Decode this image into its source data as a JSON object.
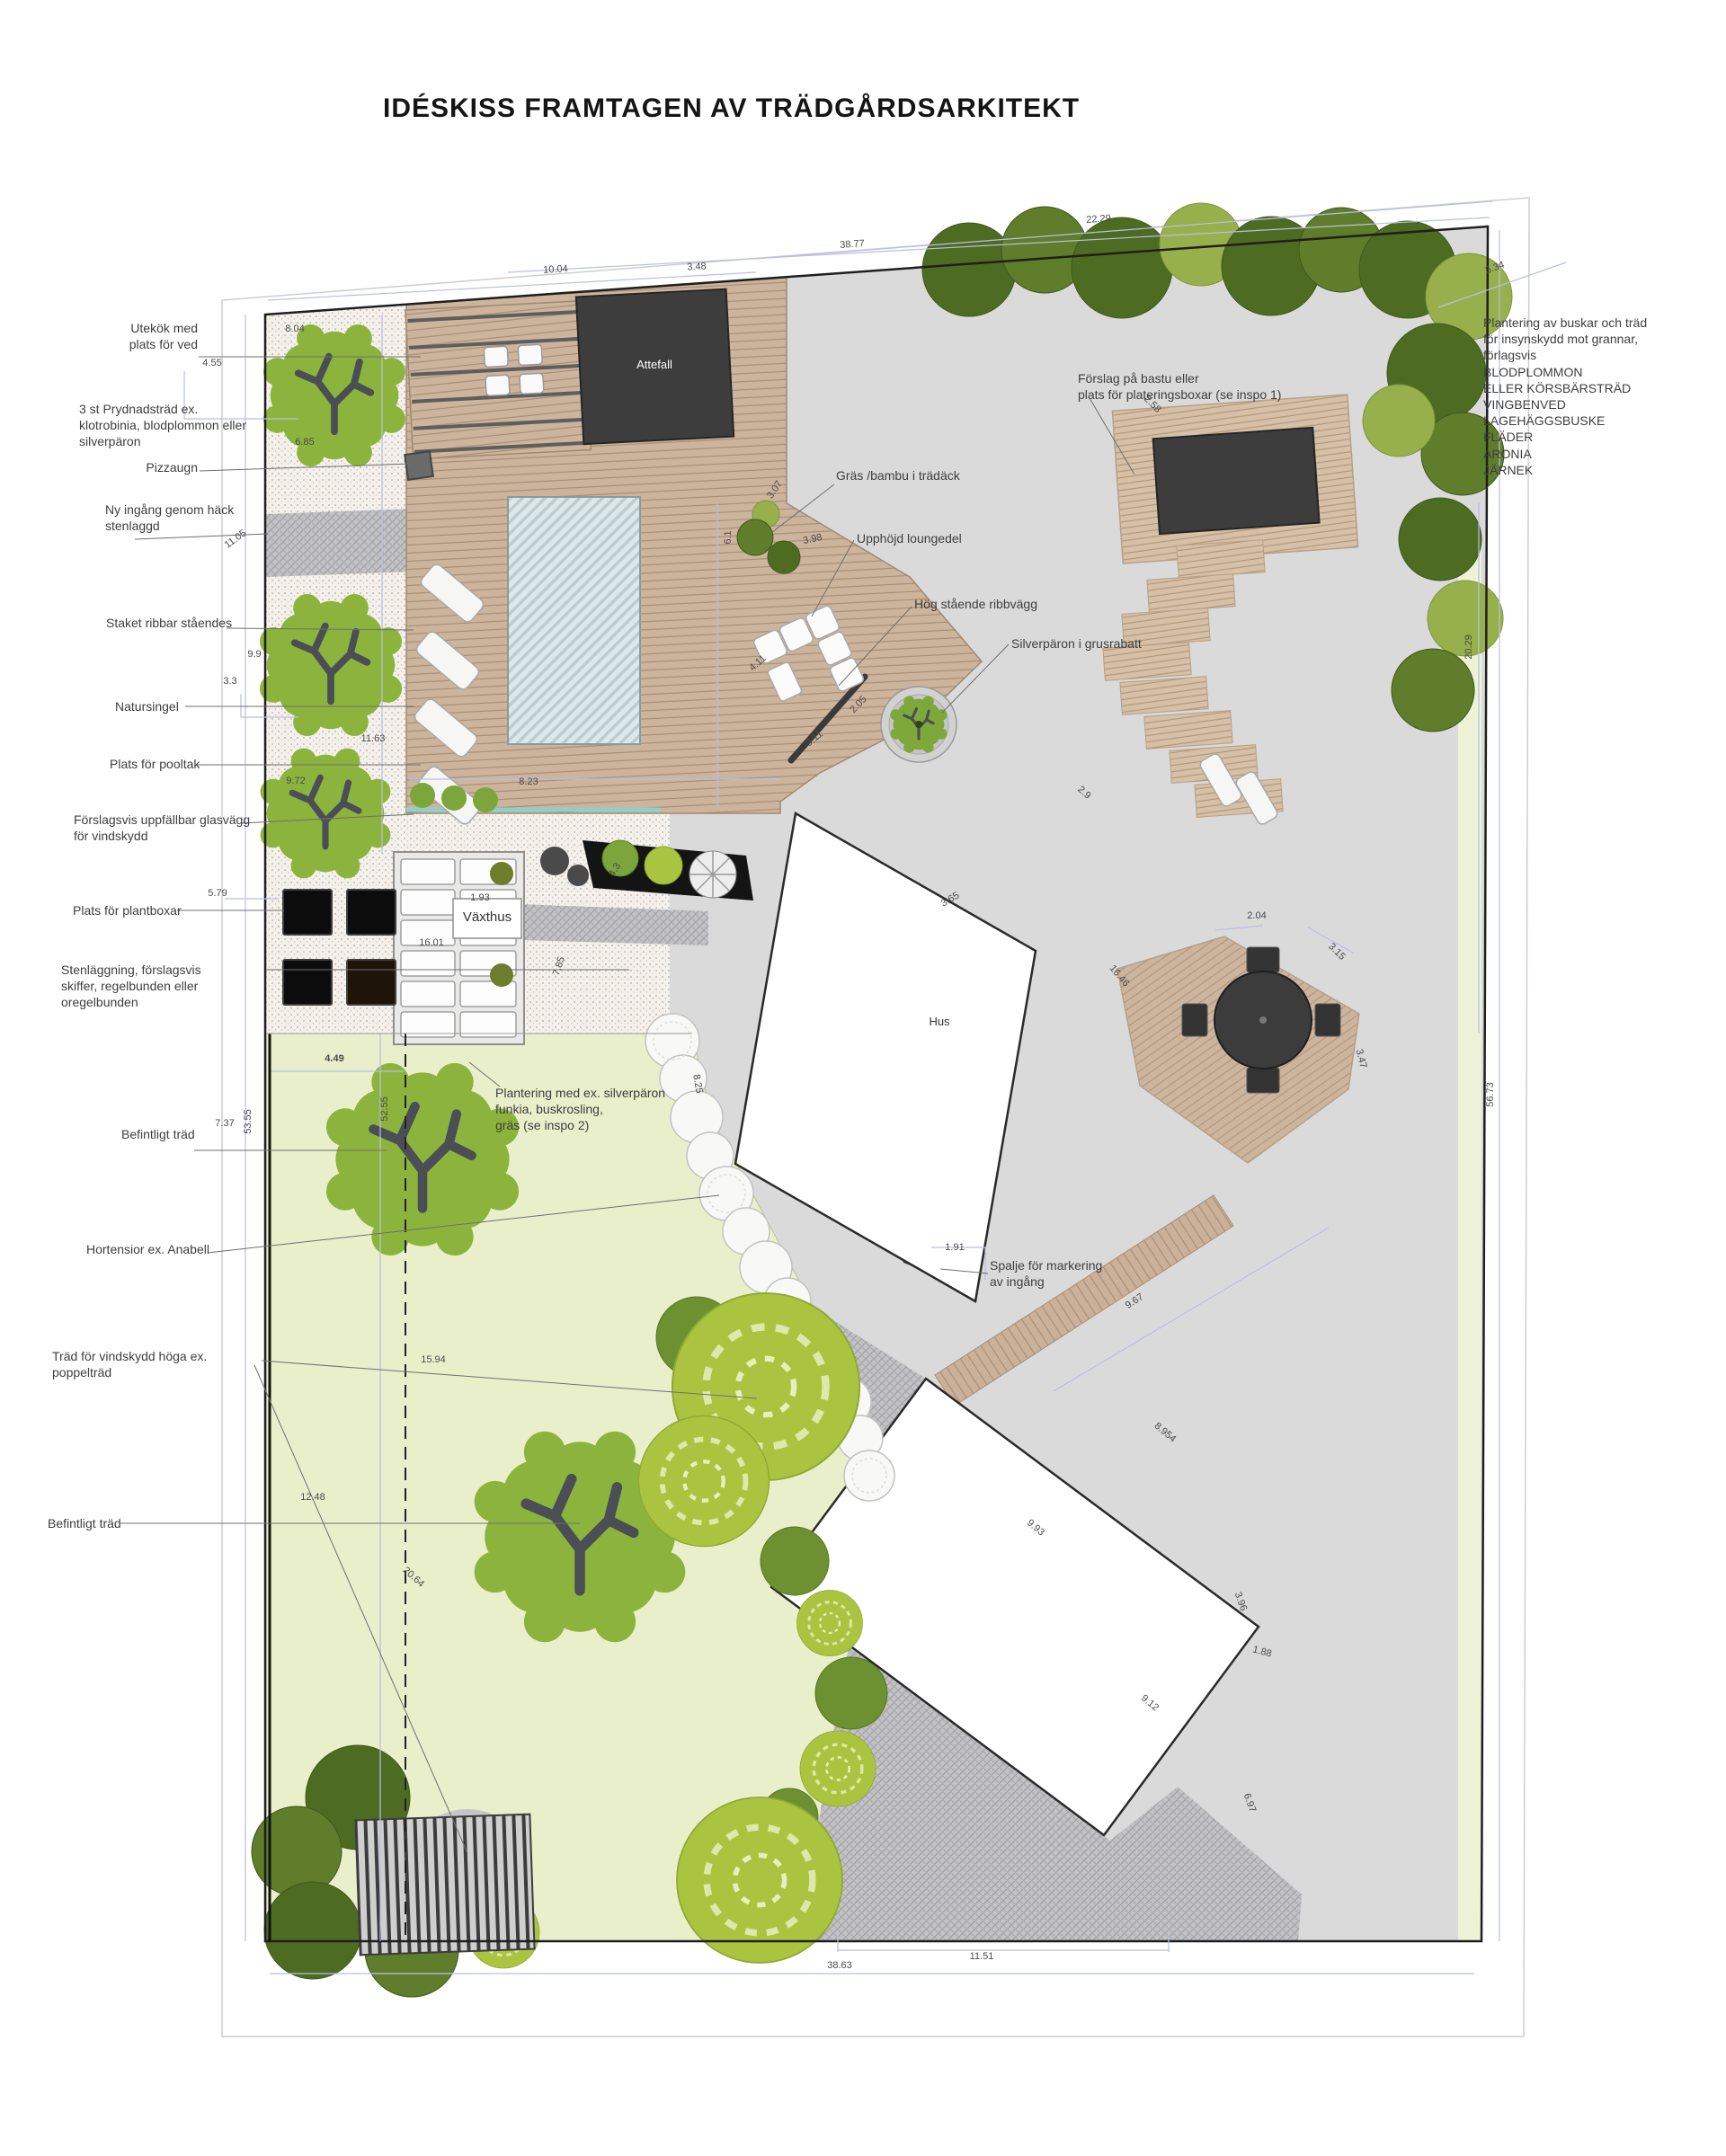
{
  "title": "IDÉSKISS FRAMTAGEN AV TRÄDGÅRDSARKITEKT",
  "plan": {
    "buildings": {
      "attefall": "Attefall",
      "vaxthus": "Växthus",
      "hus": "Hus"
    },
    "annotations": [
      {
        "text": "Utekök med\nplats för ved"
      },
      {
        "text": "3 st Prydnadsträd ex.\nklotrobinia, blodplommon eller\nsilverpäron"
      },
      {
        "text": "Pizzaugn"
      },
      {
        "text": "Ny ingång genom häck\nstenlaggd"
      },
      {
        "text": "Staket ribbar ståendes"
      },
      {
        "text": "Natursingel"
      },
      {
        "text": "Plats för pooltak"
      },
      {
        "text": "Förslagsvis uppfällbar glasvägg\nför vindskydd"
      },
      {
        "text": "Plats för plantboxar"
      },
      {
        "text": "Stenläggning, förslagsvis\nskiffer, regelbunden eller oregelbunden"
      },
      {
        "text": "Befintligt träd"
      },
      {
        "text": "Hortensior ex. Anabell"
      },
      {
        "text": "Träd för vindskydd höga ex. poppelträd"
      },
      {
        "text": "Befintligt träd"
      },
      {
        "text": "Gräs /bambu i trädäck"
      },
      {
        "text": "Upphöjd loungedel"
      },
      {
        "text": "Hög stående ribbvägg"
      },
      {
        "text": "Silverpäron i grusrabatt"
      },
      {
        "text": "Förslag på bastu eller\nplats för plateringsboxar (se inspo 1)"
      },
      {
        "text": "Plantering av buskar och träd\nför insynskydd mot grannar, förlagsvis\nBLODPLOMMON\nELLER KÖRSBÄRSTRÄD\nVINGBENVED\nLAGEHÄGGSBUSKE\nFLÄDER\nARONIA\nJÄRNEK"
      },
      {
        "text": "Plantering med ex. silverpäron\nfunkia, buskrosling,\ngräs (se inspo 2)"
      },
      {
        "text": "Spalje för markering\nav ingång"
      }
    ],
    "dims": [
      {
        "v": "10.04"
      },
      {
        "v": "3.48"
      },
      {
        "v": "38.77"
      },
      {
        "v": "22.29"
      },
      {
        "v": "5.34"
      },
      {
        "v": "8.04"
      },
      {
        "v": "4.55"
      },
      {
        "v": "6.85"
      },
      {
        "v": "11.05"
      },
      {
        "v": "9.9"
      },
      {
        "v": "3.3"
      },
      {
        "v": "11.63"
      },
      {
        "v": "9.72"
      },
      {
        "v": "5.79"
      },
      {
        "v": "16.01"
      },
      {
        "v": "1.93"
      },
      {
        "v": "7.85"
      },
      {
        "v": "4.3"
      },
      {
        "v": "4.49"
      },
      {
        "v": "7.37"
      },
      {
        "v": "53.55"
      },
      {
        "v": "52.55"
      },
      {
        "v": "15.94"
      },
      {
        "v": "12.48"
      },
      {
        "v": "20.64"
      },
      {
        "v": "8.23"
      },
      {
        "v": "6.1"
      },
      {
        "v": "3.98"
      },
      {
        "v": "4.11"
      },
      {
        "v": "9.11"
      },
      {
        "v": "3.07"
      },
      {
        "v": "2.05"
      },
      {
        "v": "3.65"
      },
      {
        "v": "2.58"
      },
      {
        "v": "2.9"
      },
      {
        "v": "2.04"
      },
      {
        "v": "3.15"
      },
      {
        "v": "16.46"
      },
      {
        "v": "3.47"
      },
      {
        "v": "9.67"
      },
      {
        "v": "1.91"
      },
      {
        "v": "9.93"
      },
      {
        "v": "8.954"
      },
      {
        "v": "3.96"
      },
      {
        "v": "1.88"
      },
      {
        "v": "9.12"
      },
      {
        "v": "6.97"
      },
      {
        "v": "11.51"
      },
      {
        "v": "38.63"
      },
      {
        "v": "56.73"
      },
      {
        "v": "20.29"
      },
      {
        "v": "8.25"
      }
    ]
  }
}
